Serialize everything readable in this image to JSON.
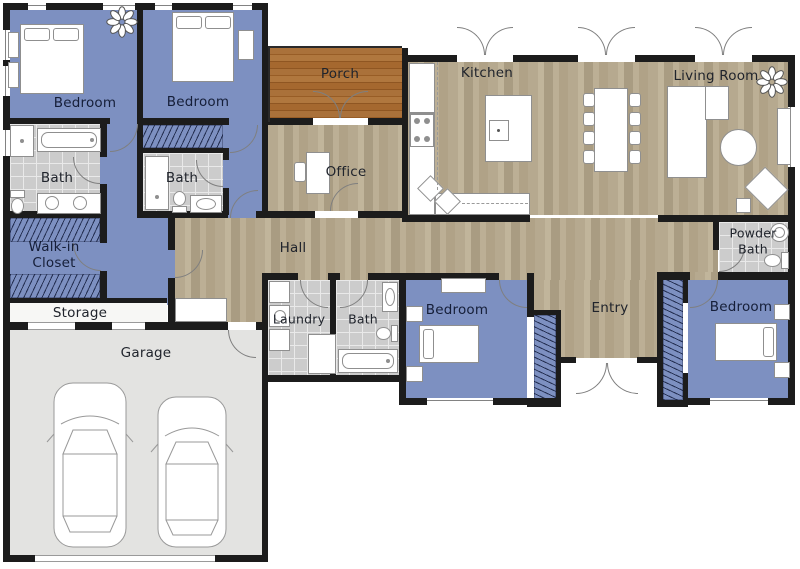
{
  "plan_type": "floor-plan",
  "colors": {
    "wall": "#1c1c1c",
    "bedroom_floor": "#7d90c1",
    "wood_floor": "#b5a88e",
    "porch_floor": "#a76a31",
    "tile_floor": "#cccccc",
    "garage_floor": "#e3e3e1",
    "furniture": "#ffffff"
  },
  "rooms": {
    "bedroom_top_left": {
      "label": "Bedroom"
    },
    "bedroom_top_mid": {
      "label": "Bedroom"
    },
    "bath_top_left": {
      "label": "Bath"
    },
    "bath_top_mid": {
      "label": "Bath"
    },
    "walk_in_closet": {
      "label_line1": "Walk-in",
      "label_line2": "Closet"
    },
    "storage": {
      "label": "Storage"
    },
    "garage": {
      "label": "Garage"
    },
    "porch": {
      "label": "Porch"
    },
    "office": {
      "label": "Office"
    },
    "hall": {
      "label": "Hall"
    },
    "kitchen": {
      "label": "Kitchen"
    },
    "living_room": {
      "label": "Living Room"
    },
    "laundry": {
      "label": "Laundry"
    },
    "bath_middle": {
      "label": "Bath"
    },
    "bedroom_middle": {
      "label": "Bedroom"
    },
    "entry": {
      "label": "Entry"
    },
    "powder_bath": {
      "label_line1": "Powder",
      "label_line2": "Bath"
    },
    "bedroom_bottom_right": {
      "label": "Bedroom"
    }
  }
}
